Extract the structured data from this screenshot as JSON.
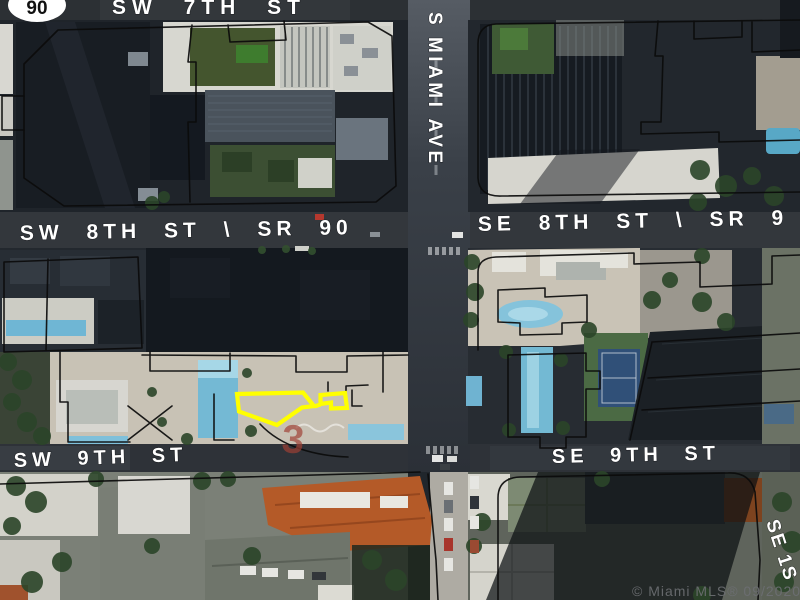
{
  "map": {
    "route_shield": "90",
    "streets": {
      "top": "SW 7TH ST",
      "vertical": "S MIAMI AVE",
      "mid_left": "SW 8TH ST \\ SR 90",
      "mid_right": "SE 8TH ST \\ SR 9",
      "lower_left": "SW 9TH ST",
      "lower_right": "SE 9TH ST",
      "right_edge": "SE 1S"
    },
    "art_marker": "3",
    "watermark": "© Miami MLS® 09/2020",
    "colors": {
      "parcel_highlight": "#FFFF00",
      "parcel_line": "#0b0b0b",
      "street_label": "#FFFFFF",
      "watermark": "#6d6f73",
      "art_red": "#a04034"
    }
  }
}
